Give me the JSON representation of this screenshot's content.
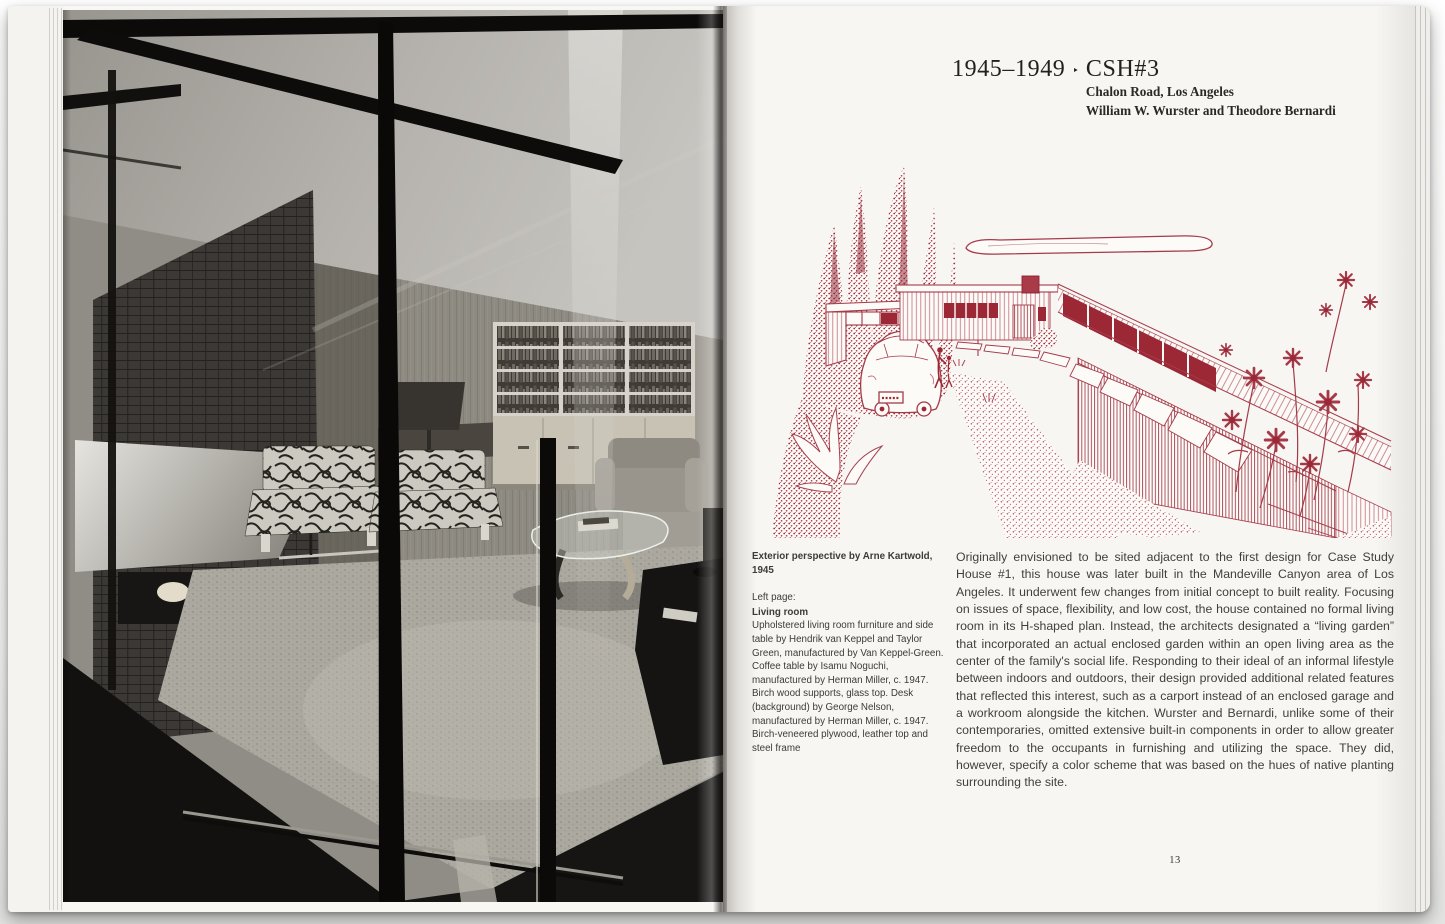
{
  "book": {
    "left_page": {
      "photo": {
        "description": "Black-and-white photograph of the living room seen through a floor-to-ceiling glass wall with dark mullions: brick fireplace with metal hood, wood-panelled walls, built-in bookshelves over cabinets, patterned lounge chairs, a grey armchair and a Noguchi glass-top coffee table on carpet",
        "tones": {
          "shadow": "#111010",
          "midtone": "#8f8b84",
          "highlight": "#cbc9c4"
        }
      }
    },
    "right_page": {
      "header": {
        "years": "1945–1949",
        "separator": "‣",
        "title": "CSH#3",
        "subtitle_line1": "Chalon Road, Los Angeles",
        "subtitle_line2": "William W. Wurster and Theodore Bernardi"
      },
      "illustration": {
        "description": "Red ink exterior perspective drawing of Case Study House #3 with cypress trees, carport, automobile, flagstone path and flowering plants",
        "ink_color": "#a53a49"
      },
      "caption": {
        "credit": "Exterior perspective by Arne Kartwold, 1945",
        "page_label": "Left page:",
        "subject": "Living room",
        "body": "Upholstered living room furniture and side table by Hendrik van Keppel and Taylor Green, manufactured by Van Keppel-Green. Coffee table by Isamu Noguchi, manufactured by Herman Miller, c. 1947. Birch wood supports, glass top. Desk (background) by George Nelson, manufactured by Herman Miller, c. 1947. Birch-veneered plywood, leather top and steel frame"
      },
      "body_text": "Originally envisioned to be sited adjacent to the first design for Case Study House #1, this house was later built in the Mandeville Canyon area of Los Angeles. It underwent few changes from initial concept to built reality. Focusing on issues of space, flexibility, and low cost, the house contained no formal living room in its H-shaped plan. Instead, the architects designated a “living garden” that incorporated an actual enclosed garden within an open living area as the center of the family's social life. Responding to their ideal of an informal lifestyle between indoors and outdoors, their design provided additional related features that reflected this interest, such as a carport instead of an enclosed garage and a workroom alongside the kitchen. Wurster and Bernardi, unlike some of their contemporaries, omitted extensive built-in components in order to allow greater freedom to the occupants in furnishing and utilizing the space. They did, however, specify a color scheme that was based on the hues of native planting surrounding the site.",
      "page_number": "13"
    }
  }
}
